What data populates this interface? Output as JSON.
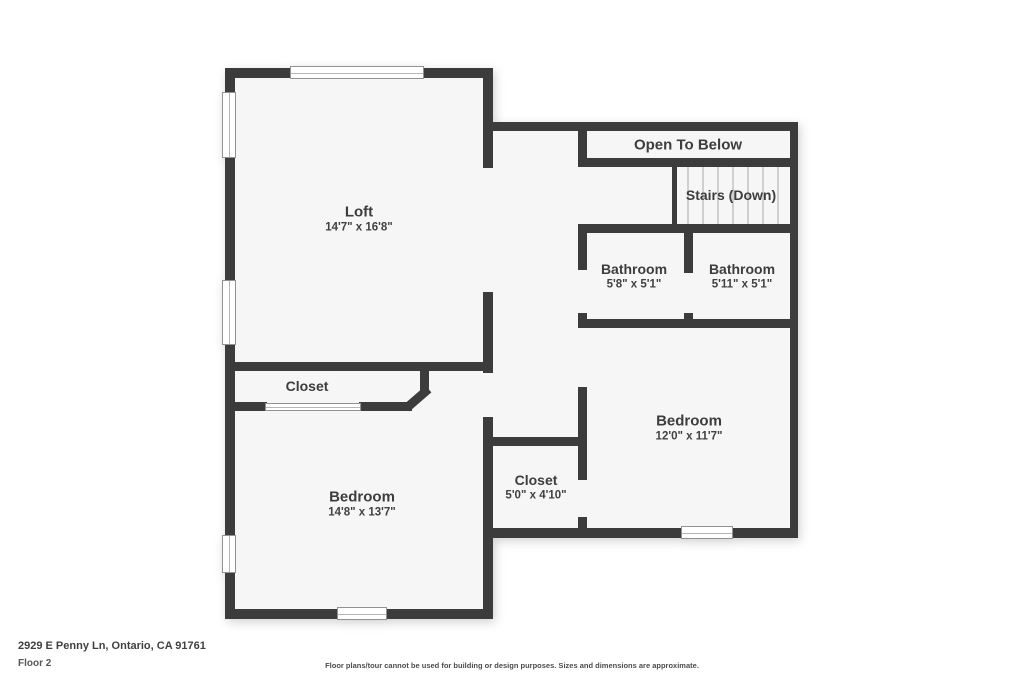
{
  "page": {
    "wall_color": "#3c3c3c",
    "room_fill": "#f6f6f6",
    "text_color": "#3d3d3d"
  },
  "rooms": {
    "loft": {
      "name": "Loft",
      "dims": "14'7\" x 16'8\""
    },
    "open_to_below": {
      "name": "Open To Below"
    },
    "stairs": {
      "name": "Stairs (Down)"
    },
    "bathroom_left": {
      "name": "Bathroom",
      "dims": "5'8\" x 5'1\""
    },
    "bathroom_right": {
      "name": "Bathroom",
      "dims": "5'11\" x 5'1\""
    },
    "bedroom_right": {
      "name": "Bedroom",
      "dims": "12'0\" x 11'7\""
    },
    "closet_left": {
      "name": "Closet"
    },
    "closet_middle": {
      "name": "Closet",
      "dims": "5'0\" x 4'10\""
    },
    "bedroom_left": {
      "name": "Bedroom",
      "dims": "14'8\" x 13'7\""
    }
  },
  "footer": {
    "address": "2929 E Penny Ln, Ontario, CA 91761",
    "floor_label": "Floor 2",
    "disclaimer": "Floor plans/tour cannot be used for building or design purposes. Sizes and dimensions are approximate."
  }
}
